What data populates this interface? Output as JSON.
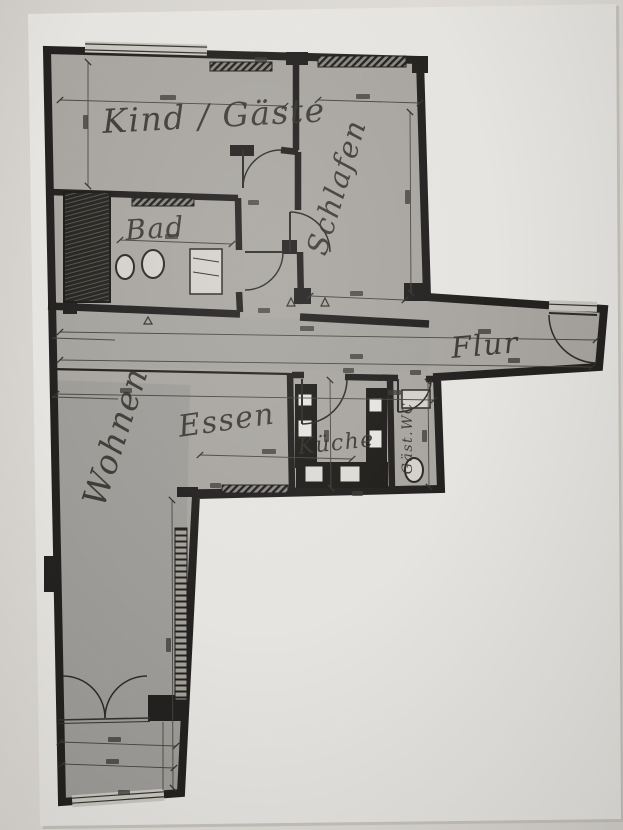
{
  "floor_plan": {
    "rooms": [
      {
        "id": "kind-gaeste",
        "label": "Kind / Gäste"
      },
      {
        "id": "schlafen",
        "label": "Schlafen"
      },
      {
        "id": "bad",
        "label": "Bad"
      },
      {
        "id": "flur",
        "label": "Flur"
      },
      {
        "id": "wohnen",
        "label": "Wohnen"
      },
      {
        "id": "essen",
        "label": "Essen"
      },
      {
        "id": "kueche",
        "label": "Küche"
      },
      {
        "id": "gaeste-wc",
        "label": "Gäst.WC"
      }
    ],
    "colors": {
      "photo_background": "#d7d4cf",
      "sheet": "#f3f2ee",
      "scan_fill": "#c9c6c0",
      "wall_ink": "#242220",
      "handwriting_ink": "#34322d"
    }
  }
}
